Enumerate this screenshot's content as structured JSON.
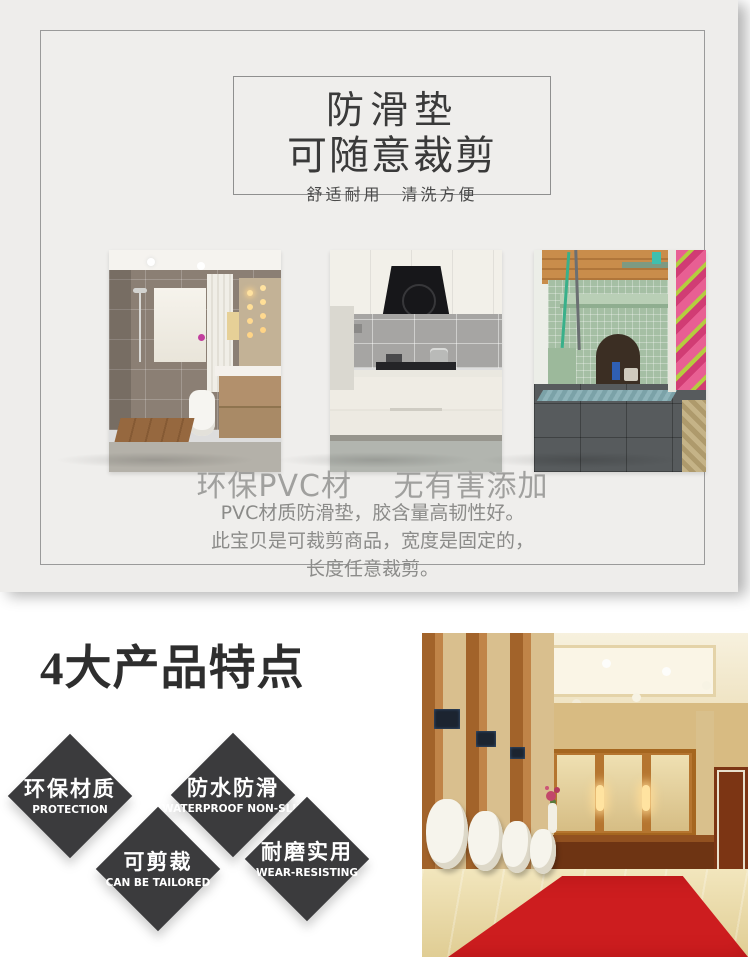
{
  "hero": {
    "title_line1": "防滑垫",
    "title_line2": "可随意裁剪",
    "tagline": "舒适耐用　清洗方便",
    "material_heading": "环保PVC材　 无有害添加",
    "description_lines": [
      "PVC材质防滑垫，胶含量高韧性好。",
      "此宝贝是可裁剪商品，宽度是固定的，",
      "长度任意裁剪。"
    ],
    "photos": [
      "bathroom-shower-room",
      "white-kitchen-gas-stove",
      "balcony-mosaic-utility-area"
    ]
  },
  "features": {
    "heading": "4大产品特点",
    "items": [
      {
        "zh": "环保材质",
        "en": "PROTECTION"
      },
      {
        "zh": "防水防滑",
        "en": "WATERPROOF NON-SLIP"
      },
      {
        "zh": "可剪裁",
        "en": "CAN BE TAILORED"
      },
      {
        "zh": "耐磨实用",
        "en": "WEAR-RESISTING"
      }
    ],
    "photo": "hotel-restroom-red-carpet"
  },
  "colors": {
    "sheet_bg": "#eeedeb",
    "card_border": "#9a9a9a",
    "title_text": "#3a3a3a",
    "muted_heading": "#a0a09e",
    "muted_text": "#8b8b89",
    "diamond": "#3b3b3d",
    "diamond_text": "#ffffff",
    "features_heading": "#2e2e2e",
    "carpet_red": "#cd1d1f"
  }
}
